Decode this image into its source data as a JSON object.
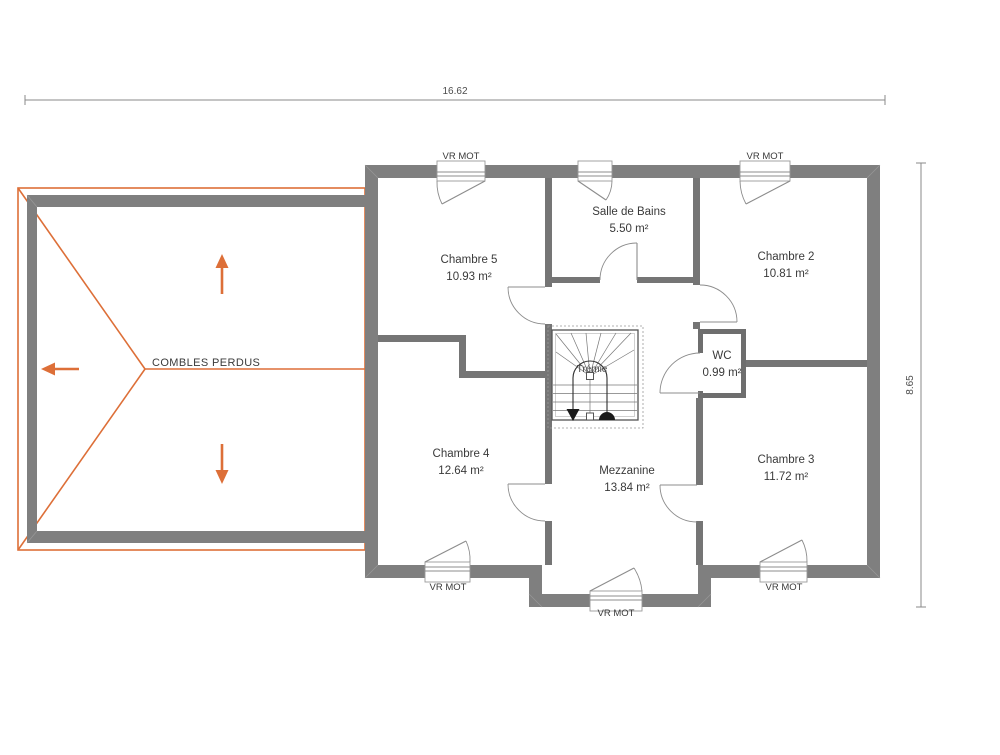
{
  "labels": {
    "attic": "COMBLES PERDUS",
    "stair_opening": "Trémie",
    "window_shutter": "VR MOT"
  },
  "dimensions": {
    "overall_width_m": "16.62",
    "overall_height_m": "8.65"
  },
  "rooms": [
    {
      "id": "chambre-5",
      "name": "Chambre 5",
      "area": "10.93 m²"
    },
    {
      "id": "salle-de-bains",
      "name": "Salle de Bains",
      "area": "5.50 m²"
    },
    {
      "id": "chambre-2",
      "name": "Chambre 2",
      "area": "10.81 m²"
    },
    {
      "id": "wc",
      "name": "WC",
      "area": "0.99 m²"
    },
    {
      "id": "chambre-4",
      "name": "Chambre 4",
      "area": "12.64 m²"
    },
    {
      "id": "mezzanine",
      "name": "Mezzanine",
      "area": "13.84 m²"
    },
    {
      "id": "chambre-3",
      "name": "Chambre 3",
      "area": "11.72 m²"
    }
  ],
  "colors": {
    "exterior_wall": "#7f7f7f",
    "interior_wall": "#757575",
    "wc_wall": "#6e6e6e",
    "roof_outline": "#dd6f38",
    "label_text": "#3a3a3a",
    "dimension_text": "#4c4c4c"
  }
}
